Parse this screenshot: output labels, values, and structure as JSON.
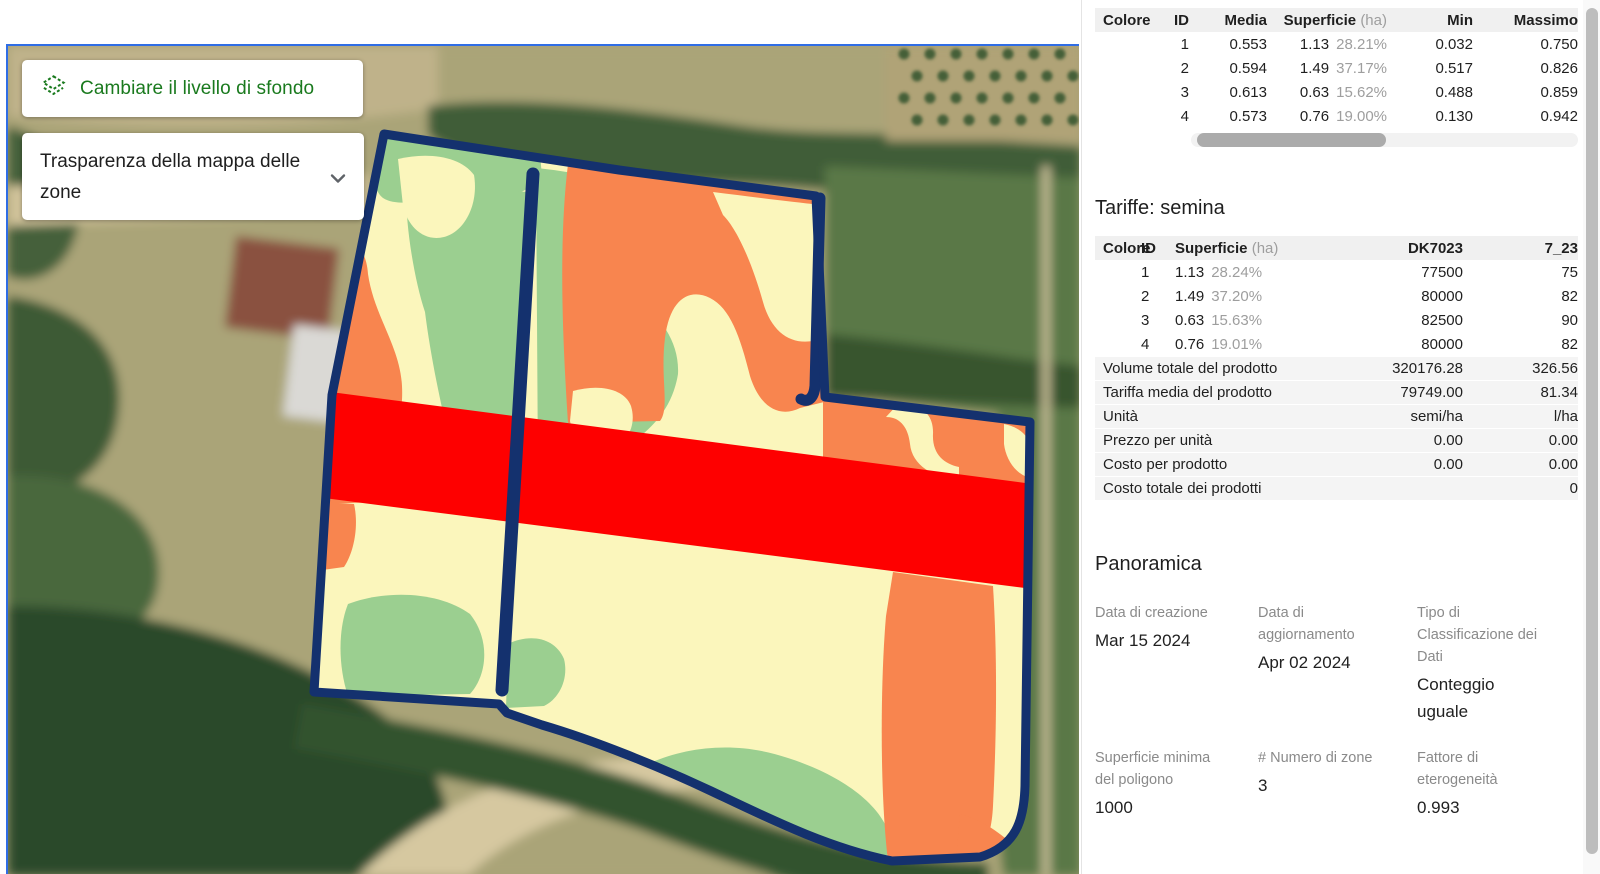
{
  "map": {
    "background_button": {
      "label": "Cambiare il livello di sfondo"
    },
    "transparency_dropdown": {
      "label": "Trasparenza della mappa delle zone"
    },
    "selection_border_color": "#2f6de5",
    "field_border_color": "#14316e"
  },
  "zone_colors": {
    "zone1": "#F8854F",
    "zone2": "#FBF6BC",
    "zone3": "#9BCF90",
    "zone4": "#FE0000"
  },
  "zones_table": {
    "headers": {
      "colore": "Colore",
      "id": "ID",
      "media": "Media",
      "superficie": "Superficie",
      "superficie_unit": "(ha)",
      "min": "Min",
      "massimo": "Massimo"
    },
    "rows": [
      {
        "color": "#F8854F",
        "id": "1",
        "media": "0.553",
        "superficie": "1.13",
        "pct": "28.21%",
        "min": "0.032",
        "massimo": "0.750"
      },
      {
        "color": "#FBF6BC",
        "id": "2",
        "media": "0.594",
        "superficie": "1.49",
        "pct": "37.17%",
        "min": "0.517",
        "massimo": "0.826"
      },
      {
        "color": "#9BCF90",
        "id": "3",
        "media": "0.613",
        "superficie": "0.63",
        "pct": "15.62%",
        "min": "0.488",
        "massimo": "0.859"
      },
      {
        "color": "#FE0000",
        "id": "4",
        "media": "0.573",
        "superficie": "0.76",
        "pct": "19.00%",
        "min": "0.130",
        "massimo": "0.942"
      }
    ]
  },
  "tariffe": {
    "title": "Tariffe: semina",
    "headers": {
      "colore": "Colore",
      "id": "ID",
      "superficie": "Superficie",
      "superficie_unit": "(ha)",
      "product1": "DK7023",
      "product2": "7_23"
    },
    "rows": [
      {
        "color": "#F8854F",
        "id": "1",
        "superficie": "1.13",
        "pct": "28.24%",
        "product1": "77500",
        "product2": "75"
      },
      {
        "color": "#FBF6BC",
        "id": "2",
        "superficie": "1.49",
        "pct": "37.20%",
        "product1": "80000",
        "product2": "82"
      },
      {
        "color": "#9BCF90",
        "id": "3",
        "superficie": "0.63",
        "pct": "15.63%",
        "product1": "82500",
        "product2": "90"
      },
      {
        "color": "#FE0000",
        "id": "4",
        "superficie": "0.76",
        "pct": "19.01%",
        "product1": "80000",
        "product2": "82"
      }
    ],
    "summary": [
      {
        "label": "Volume totale del prodotto",
        "v1": "320176.28",
        "v2": "326.56"
      },
      {
        "label": "Tariffa media del prodotto",
        "v1": "79749.00",
        "v2": "81.34"
      },
      {
        "label": "Unità",
        "v1": "semi/ha",
        "v2": "l/ha"
      },
      {
        "label": "Prezzo per unità",
        "v1": "0.00",
        "v2": "0.00"
      },
      {
        "label": "Costo per prodotto",
        "v1": "0.00",
        "v2": "0.00"
      },
      {
        "label": "Costo totale dei prodotti",
        "v1": "",
        "v2": "0"
      }
    ]
  },
  "panoramica": {
    "title": "Panoramica",
    "items": [
      {
        "label": "Data di creazione",
        "value": "Mar 15 2024"
      },
      {
        "label": "Data di aggiornamento",
        "value": "Apr 02 2024"
      },
      {
        "label": "Tipo di Classificazione dei Dati",
        "value": "Conteggio uguale"
      },
      {
        "label": "Superficie minima del poligono",
        "value": "1000"
      },
      {
        "label": "# Numero di zone",
        "value": "3"
      },
      {
        "label": "Fattore di eterogeneità",
        "value": "0.993"
      }
    ]
  }
}
